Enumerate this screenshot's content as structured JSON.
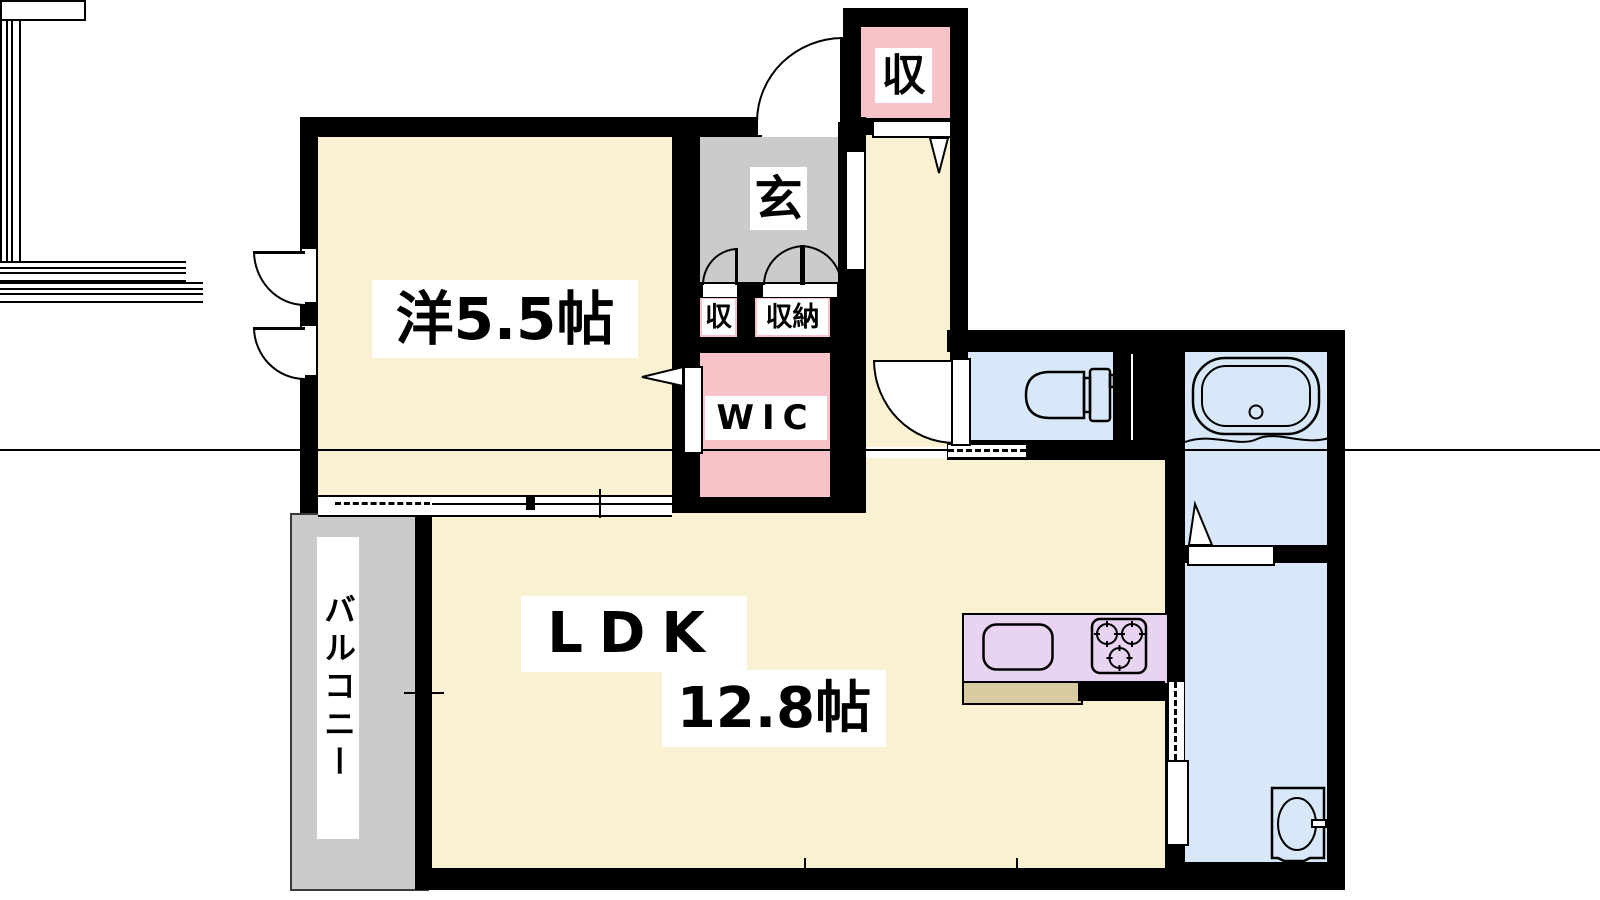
{
  "page": {
    "type": "apartment floor plan",
    "background": "#FFFFFF"
  },
  "colors": {
    "wall": "#000000",
    "cream": "#FAF0D2",
    "gray": "#CBCBCB",
    "pink": "#F8C3C8",
    "blue": "#D8E8F8",
    "purple": "#E8D4F0",
    "tan": "#D8CBA2",
    "white": "#FFFFFF",
    "text": "#000000"
  },
  "rooms": {
    "western_room": {
      "label": "洋5.5帖"
    },
    "ldk": {
      "label_line1": "LDK",
      "label_line2": "12.8帖"
    },
    "entrance": {
      "label": "玄"
    },
    "storage_upper": {
      "label": "収"
    },
    "storage_small": {
      "label": "収"
    },
    "storage_closet": {
      "label": "収納"
    },
    "walk_in_closet": {
      "label": "WIC"
    },
    "balcony": {
      "label": "バルコニー"
    }
  },
  "fixtures": {
    "toilet": "toilet-icon",
    "bathtub": "bathtub-icon",
    "washbasin": "washbasin-icon",
    "kitchen_sink": "sink-icon",
    "kitchen_stove": "stove-icon"
  }
}
